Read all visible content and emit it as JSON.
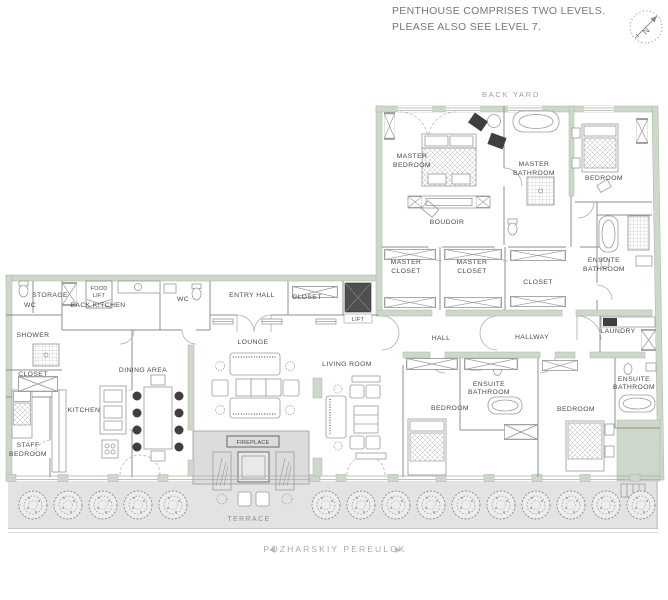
{
  "header": {
    "line1": "PENTHOUSE COMPRISES TWO LEVELS.",
    "line2": "PLEASE ALSO SEE LEVEL 7."
  },
  "compass": {
    "label": "N"
  },
  "plan": {
    "back_yard_label": "BACK YARD",
    "terrace_label": "TERRACE",
    "fireplace_label": "FIREPLACE",
    "street": {
      "left_arrow": "◀",
      "name": "POZHARSKIY PEREULOK",
      "right_arrow": "▶"
    },
    "labels": {
      "master_bedroom": [
        "MASTER",
        "BEDROOM"
      ],
      "boudoir": [
        "BOUDOIR"
      ],
      "master_bathroom": [
        "MASTER",
        "BATHROOM"
      ],
      "bedroom_ne": [
        "BEDROOM"
      ],
      "ensuite_ne": [
        "ENSUITE",
        "BATHROOM"
      ],
      "master_closet_1": [
        "MASTER",
        "CLOSET"
      ],
      "master_closet_2": [
        "MASTER",
        "CLOSET"
      ],
      "closet_n": [
        "CLOSET"
      ],
      "laundry": [
        "LAUNDRY"
      ],
      "hall": [
        "HALL"
      ],
      "hallway": [
        "HALLWAY"
      ],
      "storage": [
        "STORAGE"
      ],
      "wc_left": [
        "WC"
      ],
      "food_lift": [
        "FOOD",
        "LIFT"
      ],
      "back_kitchen": [
        "BACK KITCHEN"
      ],
      "wc_mid": [
        "WC"
      ],
      "shower": [
        "SHOWER"
      ],
      "closet_w": [
        "CLOSET"
      ],
      "entry_hall": [
        "ENTRY HALL"
      ],
      "closet_entry": [
        "CLOSET"
      ],
      "lift": [
        "LIFT"
      ],
      "lounge": [
        "LOUNGE"
      ],
      "living_room": [
        "LIVING ROOM"
      ],
      "dining_area": [
        "DINING AREA"
      ],
      "kitchen": [
        "KITCHEN"
      ],
      "staff_bedroom": [
        "STAFF",
        "BEDROOM"
      ],
      "bedroom_s1": [
        "BEDROOM"
      ],
      "ensuite_s1": [
        "ENSUITE",
        "BATHROOM"
      ],
      "bedroom_s2": [
        "BEDROOM"
      ],
      "ensuite_s2": [
        "ENSUITE",
        "BATHROOM"
      ]
    },
    "colors": {
      "wall": "#cdd7ca",
      "terrace": "#e3e3e3",
      "fireplace_block": "#dcdcdc",
      "partition_line": "#8f8f8f",
      "label_text": "#4a4a4a",
      "muted_text": "#9e9e9e",
      "lift_fill": "#4f4f4f"
    }
  }
}
